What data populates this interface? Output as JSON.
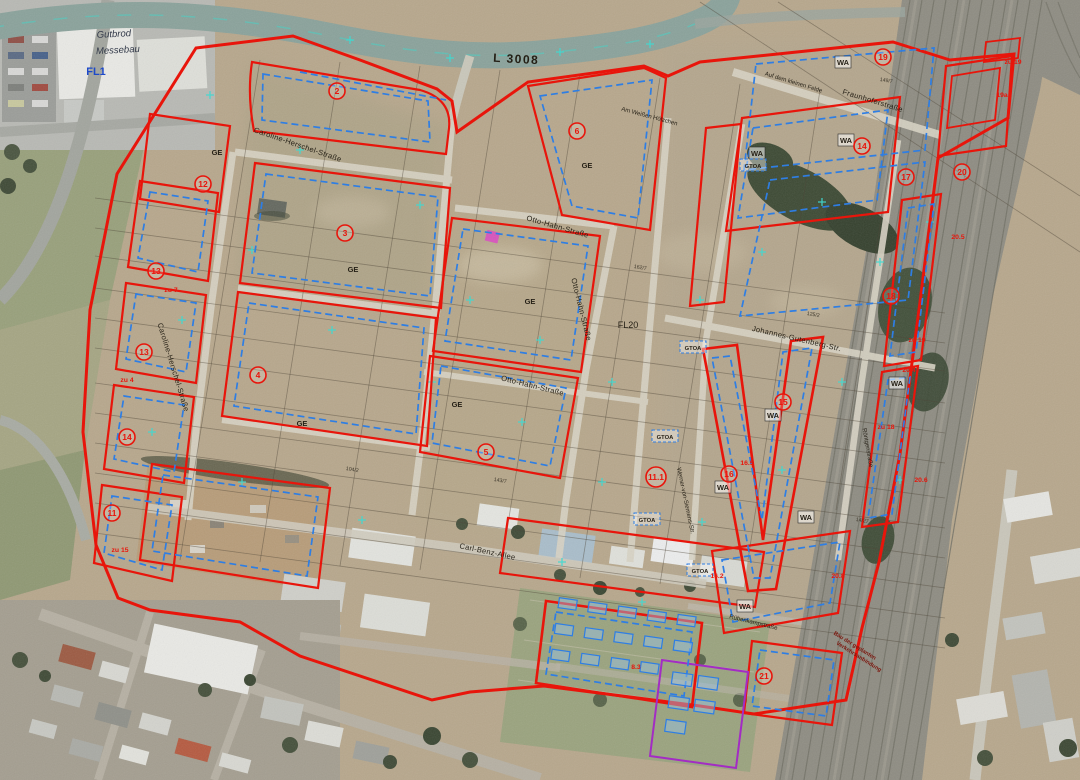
{
  "map": {
    "description": "Aerial photograph with development plan overlay (zoning boundaries, building limits, zone numbers)",
    "colors": {
      "zoning_red": "#e8150b",
      "building_limit_blue": "#2e7ee4",
      "survey_cyan": "#3fd9d2",
      "planned_violet": "#a32cc4",
      "street_text": "#241f15",
      "fl_label_blue": "#1d49c8"
    },
    "labels": [
      {
        "name": "road-label-l3008",
        "text": "L 3008",
        "x": 516,
        "y": 63,
        "rot": 3,
        "kind": "road"
      },
      {
        "name": "street-caroline-herschel-horizontal",
        "text": "Caroline-Herschel-Straße",
        "x": 297,
        "y": 147,
        "rot": 19,
        "kind": "street"
      },
      {
        "name": "street-caroline-herschel-vertical",
        "text": "Caroline-Herschel-Straße",
        "x": 171,
        "y": 368,
        "rot": 73,
        "kind": "street"
      },
      {
        "name": "street-otto-hahn-1",
        "text": "Otto-Hahn-Straße",
        "x": 557,
        "y": 229,
        "rot": 16,
        "kind": "street"
      },
      {
        "name": "street-otto-hahn-2",
        "text": "Otto-Hahn-Straße",
        "x": 579,
        "y": 310,
        "rot": 76,
        "kind": "street"
      },
      {
        "name": "street-otto-hahn-3",
        "text": "Otto-Hahn-Straße",
        "x": 532,
        "y": 388,
        "rot": 14,
        "kind": "street"
      },
      {
        "name": "street-fraunhofer",
        "text": "Fraunhoferstraße",
        "x": 872,
        "y": 103,
        "rot": 17,
        "kind": "street"
      },
      {
        "name": "street-auf-dem-kleinen-felde",
        "text": "Auf dem kleinen Felde",
        "x": 793,
        "y": 84,
        "rot": 17,
        "kind": "street-small"
      },
      {
        "name": "street-am-weissen-hoelzchen",
        "text": "Am Weißen Hölzchen",
        "x": 649,
        "y": 118,
        "rot": 15,
        "kind": "street-small"
      },
      {
        "name": "street-johannes-gutenberg",
        "text": "Johannes-Gutenberg-Str.",
        "x": 796,
        "y": 341,
        "rot": 13,
        "kind": "street"
      },
      {
        "name": "street-carl-benz-allee",
        "text": "Carl-Benz-Allee",
        "x": 487,
        "y": 554,
        "rot": 12,
        "kind": "street"
      },
      {
        "name": "street-werner-von-siemens",
        "text": "Werner-von-Siemens-Str.",
        "x": 684,
        "y": 501,
        "rot": 78,
        "kind": "street-small"
      },
      {
        "name": "street-roentgen",
        "text": "Röntgenstraße",
        "x": 866,
        "y": 448,
        "rot": 80,
        "kind": "street-small"
      },
      {
        "name": "street-ruebenkamp",
        "text": "Rübenkampstraße",
        "x": 753,
        "y": 624,
        "rot": 14,
        "kind": "street-small"
      },
      {
        "name": "area-label-fl1",
        "text": "FL1",
        "x": 96,
        "y": 75,
        "rot": 0,
        "kind": "fl-blue"
      },
      {
        "name": "area-label-fl20",
        "text": "FL20",
        "x": 628,
        "y": 328,
        "rot": 0,
        "kind": "fl-black"
      },
      {
        "name": "use-label-ge-1",
        "text": "GE",
        "x": 217,
        "y": 155,
        "rot": 0,
        "kind": "use"
      },
      {
        "name": "use-label-ge-2",
        "text": "GE",
        "x": 353,
        "y": 272,
        "rot": 0,
        "kind": "use"
      },
      {
        "name": "use-label-ge-3",
        "text": "GE",
        "x": 302,
        "y": 426,
        "rot": 0,
        "kind": "use"
      },
      {
        "name": "use-label-ge-4",
        "text": "GE",
        "x": 530,
        "y": 304,
        "rot": 0,
        "kind": "use"
      },
      {
        "name": "use-label-ge-5",
        "text": "GE",
        "x": 587,
        "y": 168,
        "rot": 0,
        "kind": "use"
      },
      {
        "name": "use-label-ge-6",
        "text": "GE",
        "x": 457,
        "y": 407,
        "rot": 0,
        "kind": "use"
      },
      {
        "name": "use-label-wa-1",
        "text": "WA",
        "x": 843,
        "y": 65,
        "rot": 0,
        "kind": "use",
        "box": true,
        "bw": 16
      },
      {
        "name": "use-label-wa-2",
        "text": "WA",
        "x": 846,
        "y": 143,
        "rot": 0,
        "kind": "use",
        "box": true,
        "bw": 16
      },
      {
        "name": "use-label-wa-3",
        "text": "WA",
        "x": 757,
        "y": 156,
        "rot": 0,
        "kind": "use",
        "box": true,
        "bw": 16
      },
      {
        "name": "use-label-wa-4",
        "text": "WA",
        "x": 773,
        "y": 418,
        "rot": 0,
        "kind": "use",
        "box": true,
        "bw": 16
      },
      {
        "name": "use-label-wa-5",
        "text": "WA",
        "x": 897,
        "y": 386,
        "rot": 0,
        "kind": "use",
        "box": true,
        "bw": 16
      },
      {
        "name": "use-label-wa-6",
        "text": "WA",
        "x": 723,
        "y": 490,
        "rot": 0,
        "kind": "use",
        "box": true,
        "bw": 16
      },
      {
        "name": "use-label-wa-7",
        "text": "WA",
        "x": 806,
        "y": 520,
        "rot": 0,
        "kind": "use",
        "box": true,
        "bw": 16
      },
      {
        "name": "use-label-wa-8",
        "text": "WA",
        "x": 745,
        "y": 609,
        "rot": 0,
        "kind": "use",
        "box": true,
        "bw": 16
      },
      {
        "name": "use-label-gtoa-1",
        "text": "GTOA",
        "x": 753,
        "y": 168,
        "rot": 0,
        "kind": "gtoa",
        "box": true,
        "bw": 26
      },
      {
        "name": "use-label-gtoa-2",
        "text": "GTOA",
        "x": 693,
        "y": 350,
        "rot": 0,
        "kind": "gtoa",
        "box": true,
        "bw": 26
      },
      {
        "name": "use-label-gtoa-3",
        "text": "GTOA",
        "x": 665,
        "y": 439,
        "rot": 0,
        "kind": "gtoa",
        "box": true,
        "bw": 26
      },
      {
        "name": "use-label-gtoa-4",
        "text": "GTOA",
        "x": 647,
        "y": 522,
        "rot": 0,
        "kind": "gtoa",
        "box": true,
        "bw": 26
      },
      {
        "name": "use-label-gtoa-5",
        "text": "GTOA",
        "x": 700,
        "y": 573,
        "rot": 0,
        "kind": "gtoa",
        "box": true,
        "bw": 26
      },
      {
        "name": "zone-note-zu7",
        "text": "zu 7",
        "x": 171,
        "y": 292,
        "rot": 0,
        "kind": "red-note"
      },
      {
        "name": "zone-note-zu4",
        "text": "zu 4",
        "x": 127,
        "y": 382,
        "rot": 0,
        "kind": "red-note"
      },
      {
        "name": "zone-note-zu15",
        "text": "zu 15",
        "x": 120,
        "y": 552,
        "rot": 0,
        "kind": "red-note"
      },
      {
        "name": "zone-note-zu19-a",
        "text": "zu 19",
        "x": 917,
        "y": 342,
        "rot": 0,
        "kind": "red-note"
      },
      {
        "name": "zone-note-zu18",
        "text": "zu 18",
        "x": 886,
        "y": 429,
        "rot": 0,
        "kind": "red-note"
      },
      {
        "name": "zone-note-zu19-b",
        "text": "zu 19",
        "x": 1013,
        "y": 64,
        "rot": 0,
        "kind": "red-note"
      },
      {
        "name": "zone-note-19a",
        "text": "19a",
        "x": 1002,
        "y": 97,
        "rot": 0,
        "kind": "red-note"
      },
      {
        "name": "zone-note-20-4",
        "text": "20.4",
        "x": 909,
        "y": 372,
        "rot": 0,
        "kind": "red-note"
      },
      {
        "name": "zone-note-20-5",
        "text": "20.5",
        "x": 958,
        "y": 239,
        "rot": 0,
        "kind": "red-note"
      },
      {
        "name": "zone-note-20-6",
        "text": "20.6",
        "x": 921,
        "y": 482,
        "rot": 0,
        "kind": "red-note"
      },
      {
        "name": "zone-note-20-8",
        "text": "20.8",
        "x": 838,
        "y": 578,
        "rot": 0,
        "kind": "red-note"
      },
      {
        "name": "zone-note-16-2",
        "text": "16.2",
        "x": 717,
        "y": 578,
        "rot": 0,
        "kind": "red-note"
      },
      {
        "name": "zone-note-16-5",
        "text": "16.5",
        "x": 747,
        "y": 465,
        "rot": 0,
        "kind": "red-note"
      },
      {
        "name": "zone-note-8-3",
        "text": "8.3",
        "x": 636,
        "y": 669,
        "rot": 0,
        "kind": "red-note"
      },
      {
        "name": "parcel-number-1",
        "text": "149/7",
        "x": 886,
        "y": 82,
        "rot": 10,
        "kind": "parcel"
      },
      {
        "name": "parcel-number-2",
        "text": "125/2",
        "x": 813,
        "y": 316,
        "rot": 10,
        "kind": "parcel"
      },
      {
        "name": "parcel-number-3",
        "text": "162/7",
        "x": 640,
        "y": 269,
        "rot": 10,
        "kind": "parcel"
      },
      {
        "name": "parcel-number-4",
        "text": "143/7",
        "x": 500,
        "y": 482,
        "rot": 10,
        "kind": "parcel"
      },
      {
        "name": "parcel-number-5",
        "text": "104/2",
        "x": 352,
        "y": 471,
        "rot": 10,
        "kind": "parcel"
      },
      {
        "name": "parcel-number-6",
        "text": "14/27",
        "x": 862,
        "y": 522,
        "rot": 10,
        "kind": "parcel"
      },
      {
        "name": "handwriting-line-1",
        "text": "Gutbrod",
        "x": 114,
        "y": 37,
        "rot": -3,
        "kind": "hand"
      },
      {
        "name": "handwriting-line-2",
        "text": "Messebau",
        "x": 118,
        "y": 53,
        "rot": -3,
        "kind": "hand"
      },
      {
        "name": "note-planned-connection-1",
        "text": "Bau der geplanten",
        "x": 854,
        "y": 647,
        "rot": 32,
        "kind": "note-red"
      },
      {
        "name": "note-planned-connection-2",
        "text": "Verkehrsanbindung",
        "x": 858,
        "y": 658,
        "rot": 32,
        "kind": "note-red"
      }
    ],
    "zone_markers": [
      {
        "n": "2",
        "x": 337,
        "y": 91
      },
      {
        "n": "3",
        "x": 345,
        "y": 233
      },
      {
        "n": "4",
        "x": 258,
        "y": 375
      },
      {
        "n": "5",
        "x": 486,
        "y": 452
      },
      {
        "n": "6",
        "x": 577,
        "y": 131
      },
      {
        "n": "12",
        "x": 203,
        "y": 184
      },
      {
        "n": "13",
        "x": 156,
        "y": 271
      },
      {
        "n": "13",
        "x": 144,
        "y": 352
      },
      {
        "n": "14",
        "x": 127,
        "y": 437
      },
      {
        "n": "11",
        "x": 112,
        "y": 513
      },
      {
        "n": "11.1",
        "x": 656,
        "y": 477
      },
      {
        "n": "14",
        "x": 862,
        "y": 146
      },
      {
        "n": "15",
        "x": 783,
        "y": 402
      },
      {
        "n": "16",
        "x": 729,
        "y": 474
      },
      {
        "n": "17",
        "x": 906,
        "y": 177
      },
      {
        "n": "18",
        "x": 891,
        "y": 296
      },
      {
        "n": "19",
        "x": 883,
        "y": 57
      },
      {
        "n": "20",
        "x": 962,
        "y": 172
      },
      {
        "n": "21",
        "x": 764,
        "y": 676
      }
    ]
  }
}
